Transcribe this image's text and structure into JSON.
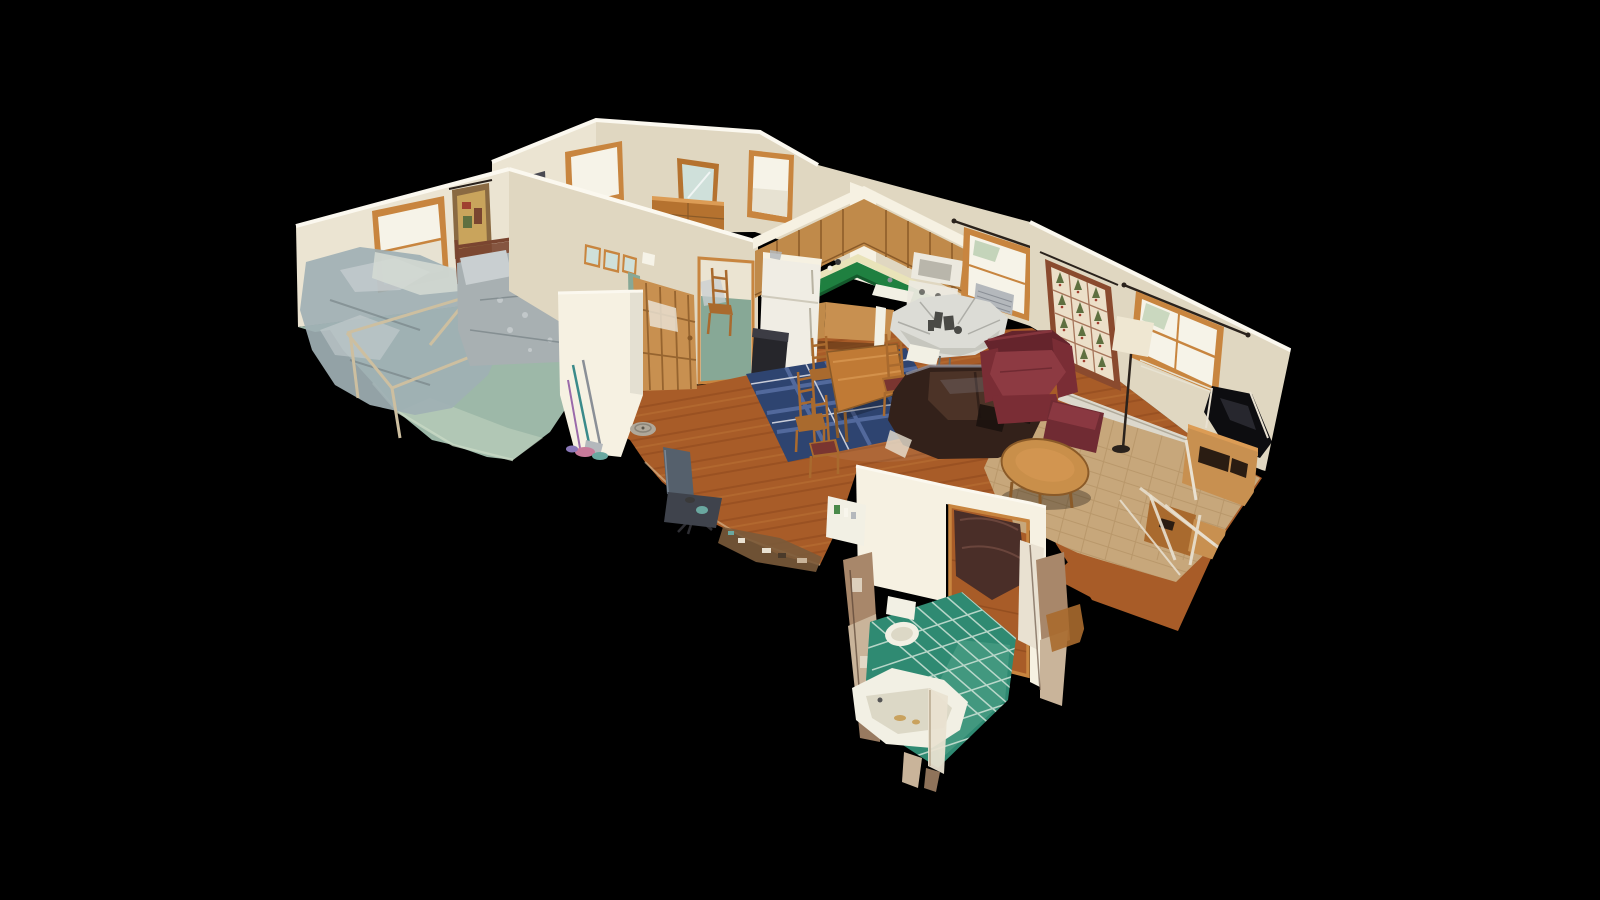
{
  "scene": {
    "view_type": "3d-dollhouse-cutaway",
    "description": "Photogrammetry (Matterport-style) dollhouse view of a single-story home interior seen from above at an angle, floating on a black void, with torn-geometry scan artifacts along the cut edges",
    "rooms": [
      {
        "name": "bedroom-1",
        "contents": [
          "twin bed with wooden headboard and gray floral quilt",
          "second bed with metal frame (scan-ghosted geometry)",
          "window with wood trim",
          "wall tapestry",
          "seafoam green carpet",
          "cutaway wall with broom and cleaning tools"
        ]
      },
      {
        "name": "bedroom-2",
        "contents": [
          "wood dresser with mirror",
          "two wood-trimmed windows",
          "small picture frame",
          "sage green carpet",
          "wooden chair and floral bedding seen through doorway"
        ]
      },
      {
        "name": "hallway",
        "contents": [
          "open pine door",
          "three small picture frames",
          "robot vacuum",
          "gray office chair",
          "debris pile at cut edge",
          "hardwood floor"
        ]
      },
      {
        "name": "kitchen",
        "contents": [
          "oak upper cabinets in L-shape",
          "green laminate countertop with sink",
          "white refrigerator",
          "white microwave and range",
          "black step trash can",
          "window with air-conditioner unit and black curtain rod"
        ]
      },
      {
        "name": "dining-area",
        "contents": [
          "wooden dining table",
          "ladder-back wood chairs with maroon seats",
          "navy plaid area rug",
          "round table scan-distorted into gray blob with glass centerpiece"
        ]
      },
      {
        "name": "living-room",
        "contents": [
          "dark brown leather sofa with black pillows",
          "burgundy leather armchair",
          "burgundy ottoman",
          "oval oak coffee table",
          "sisal area rug",
          "christmas-tree quilt wall hanging",
          "wood-trimmed window with curtain rod",
          "arched floor lamp",
          "television on wooden media stand (scan-torn)",
          "baseboard heater"
        ]
      },
      {
        "name": "bathroom",
        "contents": [
          "teal tile floor with light grout grid",
          "white toilet",
          "white bathtub",
          "medicine shelf with toiletries",
          "doorway to den with dark leather chair",
          "torn scan-artifact wall fragments"
        ]
      }
    ],
    "background": "black void"
  },
  "colors": {
    "bg": "#000000",
    "wall_cream": "#ebe4d2",
    "wall_cream_dim": "#e0d7c1",
    "wall_bright": "#f6f1e2",
    "wall_top_strip": "#fbf8ef",
    "trim_wood": "#c8853f",
    "door_wood": "#c89050",
    "dresser_wood": "#b5722f",
    "cabinet_wood": "#c08a4a",
    "cabinet_line": "#8a5a28",
    "counter_green": "#1f8040",
    "counter_green_dark": "#145a2c",
    "backsplash": "#e9e3b9",
    "floor_wood": "#a85c28",
    "floor_wood_dark": "#84431a",
    "floor_wood_light": "#c57f3e",
    "edge_light": "#e6d3ae",
    "carpet_sage": "#9db8a8",
    "carpet_sage_light": "#c9dac6",
    "carpet_b2": "#87a896",
    "bed_quilt": "#a8b0b2",
    "bed_quilt_light": "#c9cfd1",
    "bed_fold": "#6e7a7e",
    "bed_ghost": "#9fb0b4",
    "sheet_white": "#d5dad4",
    "headboard": "#7a4530",
    "metal_frame": "#cdbfa0",
    "fridge_white": "#f0ede4",
    "appliance_white": "#ece9df",
    "appliance_inner": "#b9b6ab",
    "trash_black": "#26262b",
    "trash_lid": "#3c3c44",
    "rug_navy": "#2e4470",
    "rug_navy_line": "#52699c",
    "rug_white_line": "#c9cdd9",
    "table_wood": "#c07a35",
    "table_wood_light": "#dc9c55",
    "chair_wood": "#a96a2e",
    "seat_maroon": "#7a3530",
    "sofa_dark": "#33211a",
    "sofa_mid": "#4c3327",
    "sofa_highlight": "#8d8d98",
    "pillow_black": "#1b120e",
    "armchair_burgundy": "#7a2d35",
    "armchair_dark": "#65242c",
    "armchair_light": "#8d3a42",
    "ottoman": "#702b33",
    "coffee_wood": "#c98f4a",
    "rug_sisal": "#c7a77b",
    "rug_sisal_line": "#b08e61",
    "quilt_border": "#8a4a2e",
    "quilt_field": "#ecdfc8",
    "quilt_tree": "#5f7040",
    "quilt_red": "#a04030",
    "lamp_shade": "#efe7d2",
    "tv_black": "#0d0d10",
    "tv_sheen": "#2e2e36",
    "glitch_white": "#e9e1d1",
    "glitch_brown": "#a8876a",
    "glitch_tan": "#c9b49a",
    "tile_teal": "#2f8a72",
    "tile_light": "#5aa890",
    "grout": "#cfe3d8",
    "fixture_white": "#f2f0e4",
    "tub_inner": "#dcd8c6",
    "stain": "#c9a25e",
    "rod_dark": "#2a221c",
    "ac_gray": "#b4b8bc",
    "foliage": "#b8ccae",
    "chair_gray": "#55606c",
    "chair_gray_dark": "#3f434c",
    "roomba": "#b0a89a",
    "window_white": "#f6f3e8",
    "window_shade": "#e7e2d2",
    "mirror_glass": "#cfe0da",
    "heater": "#dcd8cc",
    "blob_light": "#dcdcd6",
    "blob_shade": "#c2c2ba",
    "blob_dark": "#4a4a46",
    "debris": "#7a5a3a",
    "den_chair": "#4a2e28",
    "den_chair_hi": "#6a453c",
    "broom_teal": "#3a8a8a",
    "broom_gray": "#8a8f96",
    "broom_purple": "#9a6aaa",
    "pile_pink": "#c87a9a",
    "pile_teal": "#6aa8a0",
    "pile_purple": "#8a78b8",
    "tp_green": "#4a8a4a",
    "tapestry_base": "#8a6a42",
    "tapestry_gold": "#c9a45c",
    "frame_dark": "#4a4a52"
  }
}
